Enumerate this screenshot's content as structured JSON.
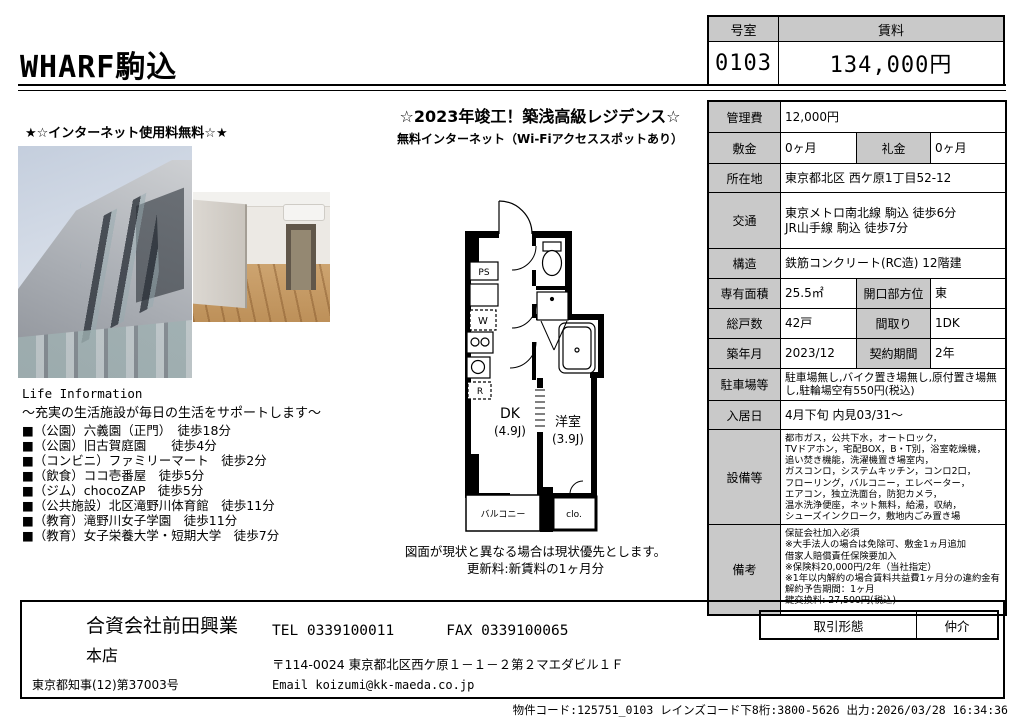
{
  "header": {
    "title": "WHARF駒込",
    "room_no_label": "号室",
    "rent_label": "賃料",
    "room_no": "0103",
    "rent": "134,000円"
  },
  "banners": {
    "left": "★☆インターネット使用料無料☆★",
    "center_main": "☆2023年竣工！築浅高級レジデンス☆",
    "center_sub": "無料インターネット（Wi-Fiアクセススポットあり）"
  },
  "life_info": {
    "heading": "Life Information",
    "subheading": "～充実の生活施設が毎日の生活をサポートします～",
    "items": [
      "■（公園）六義園（正門）　徒歩18分",
      "■（公園）旧古賀庭園　　徒歩4分",
      "■（コンビニ）ファミリーマート　徒歩2分",
      "■（飲食）ココ壱番屋　徒歩5分",
      "■（ジム）chocoZAP　徒歩5分",
      "■（公共施設）北区滝野川体育館　徒歩11分",
      "■（教育）滝野川女子学園　徒歩11分",
      "■（教育）女子栄養大学・短期大学　徒歩7分"
    ]
  },
  "floorplan": {
    "labels": {
      "ps": "PS",
      "w": "W",
      "r": "R",
      "dk": "DK",
      "dk_size": "(4.9J)",
      "western_room": "洋室",
      "western_room_size": "(3.9J)",
      "balcony": "バルコニー",
      "closet": "clo."
    },
    "caption_line1": "図面が現状と異なる場合は現状優先とします。",
    "caption_line2": "更新料:新賃料の1ヶ月分"
  },
  "details": {
    "rows": [
      {
        "cells": [
          {
            "h": true,
            "t": "管理費"
          },
          {
            "t": "12,000円",
            "span": 3
          }
        ]
      },
      {
        "cells": [
          {
            "h": true,
            "t": "敷金"
          },
          {
            "t": "0ヶ月"
          },
          {
            "h": true,
            "t": "礼金"
          },
          {
            "t": "0ヶ月"
          }
        ]
      },
      {
        "cells": [
          {
            "h": true,
            "t": "所在地"
          },
          {
            "t": "東京都北区 西ケ原1丁目52-12",
            "span": 3
          }
        ]
      },
      {
        "cells": [
          {
            "h": true,
            "t": "交通"
          },
          {
            "t": "東京メトロ南北線 駒込 徒歩6分\nJR山手線 駒込 徒歩7分",
            "span": 3
          }
        ]
      },
      {
        "cells": [
          {
            "h": true,
            "t": "構造"
          },
          {
            "t": "鉄筋コンクリート(RC造) 12階建",
            "span": 3
          }
        ]
      },
      {
        "cells": [
          {
            "h": true,
            "t": "専有面積"
          },
          {
            "t": "25.5㎡"
          },
          {
            "h": true,
            "t": "開口部方位"
          },
          {
            "t": "東"
          }
        ]
      },
      {
        "cells": [
          {
            "h": true,
            "t": "総戸数"
          },
          {
            "t": "42戸"
          },
          {
            "h": true,
            "t": "間取り"
          },
          {
            "t": "1DK"
          }
        ]
      },
      {
        "cells": [
          {
            "h": true,
            "t": "築年月"
          },
          {
            "t": "2023/12"
          },
          {
            "h": true,
            "t": "契約期間"
          },
          {
            "t": "2年"
          }
        ]
      },
      {
        "cells": [
          {
            "h": true,
            "t": "駐車場等"
          },
          {
            "t": "駐車場無し,バイク置き場無し,原付置き場無し,駐輪場空有550円(税込)",
            "span": 3,
            "size": "s"
          }
        ]
      },
      {
        "cells": [
          {
            "h": true,
            "t": "入居日"
          },
          {
            "t": "4月下旬 内見03/31～",
            "span": 3
          }
        ]
      },
      {
        "cells": [
          {
            "h": true,
            "t": "設備等"
          },
          {
            "t": "都市ガス，公共下水，オートロック，\nTVドアホン，宅配BOX，B・T別，浴室乾燥機，\n 追い焚き機能，洗濯機置き場室内，\nガスコンロ，システムキッチン，コンロ2口，\nフローリング，バルコニー，エレベーター，\nエアコン，独立洗面台，防犯カメラ，\n温水洗浄便座，ネット無料，給湯，収納，\nシューズインクローク，敷地内ごみ置き場",
            "span": 3,
            "size": "xs"
          }
        ]
      },
      {
        "cells": [
          {
            "h": true,
            "t": "備考"
          },
          {
            "t": "保証会社加入必須\n※大手法人の場合は免除可、敷金1ヵ月追加\n借家人賠償責任保険要加入\n※保険料20,000円/2年（当社指定）\n※1年以内解約の場合賃料共益費1ヶ月分の違約金有\n解約予告期間：1ヶ月\n鍵交換料: 27,500円(税込)",
            "span": 3,
            "size": "xs"
          }
        ]
      }
    ]
  },
  "company": {
    "name": "合資会社前田興業",
    "branch": "本店",
    "license": "東京都知事(12)第37003号",
    "tel": "TEL 0339100011",
    "fax": "FAX 0339100065",
    "address": "〒114-0024 東京都北区西ケ原１－１－２第２マエダビル１Ｆ",
    "email": "Email koizumi@kk-maeda.co.jp",
    "deal_type_label": "取引形態",
    "deal_type": "仲介"
  },
  "footer": {
    "line": "物件コード:125751_0103 レインズコード下8桁:3800-5626 出力:2026/03/28 16:34:36"
  }
}
